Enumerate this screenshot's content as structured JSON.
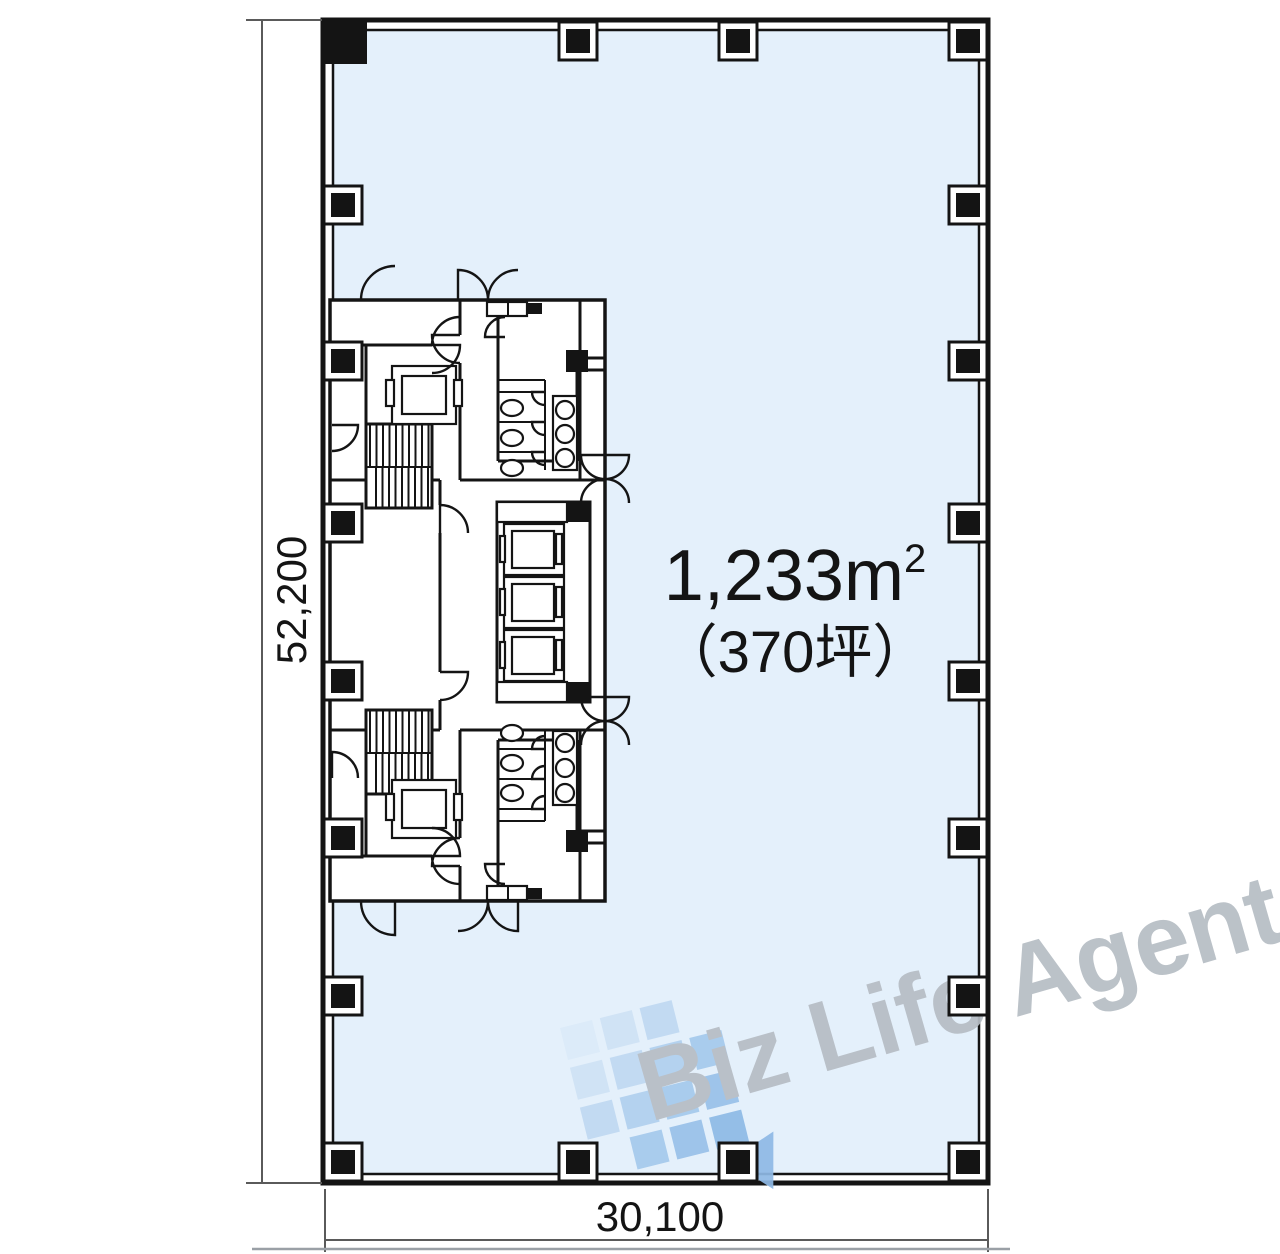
{
  "plan": {
    "area": {
      "value": "1,233m",
      "sup": "2",
      "tsubo": "（370坪）"
    },
    "dimensions": {
      "height_mm": "52,200",
      "width_mm": "30,100"
    },
    "colors": {
      "floor_fill": "#e4f0fb",
      "wall": "#141414",
      "dim_line": "#5a5a5a",
      "column_fill": "#141414",
      "column_frame": "#ffffff"
    },
    "columns": {
      "left_x": 343,
      "right_x": 968,
      "top_y": 41,
      "bottom_y": 1162,
      "side_ys": [
        205,
        361,
        523,
        681,
        838,
        996
      ],
      "edge_xs": [
        578,
        738
      ],
      "corner_topleft": {
        "x": 325,
        "y": 22,
        "size": 42
      },
      "outer_size": 38,
      "inner_size": 24
    }
  },
  "watermark": {
    "text": "Biz Life Agent",
    "text_color": "#b6bdc4",
    "logo_arrow_color": "#8fb9e6",
    "logo_tiles": [
      [
        "#dcebf9",
        "#cfe2f5",
        "#c0d9f2",
        null
      ],
      [
        "#cfe2f5",
        "#c0d9f2",
        "#b1d0ef",
        "#a5c9ec"
      ],
      [
        "#c0d9f2",
        "#b1d0ef",
        "#a5c9ec",
        "#99c1e9"
      ],
      [
        null,
        "#a5c9ec",
        "#99c1e9",
        "#8ebae6"
      ]
    ]
  }
}
